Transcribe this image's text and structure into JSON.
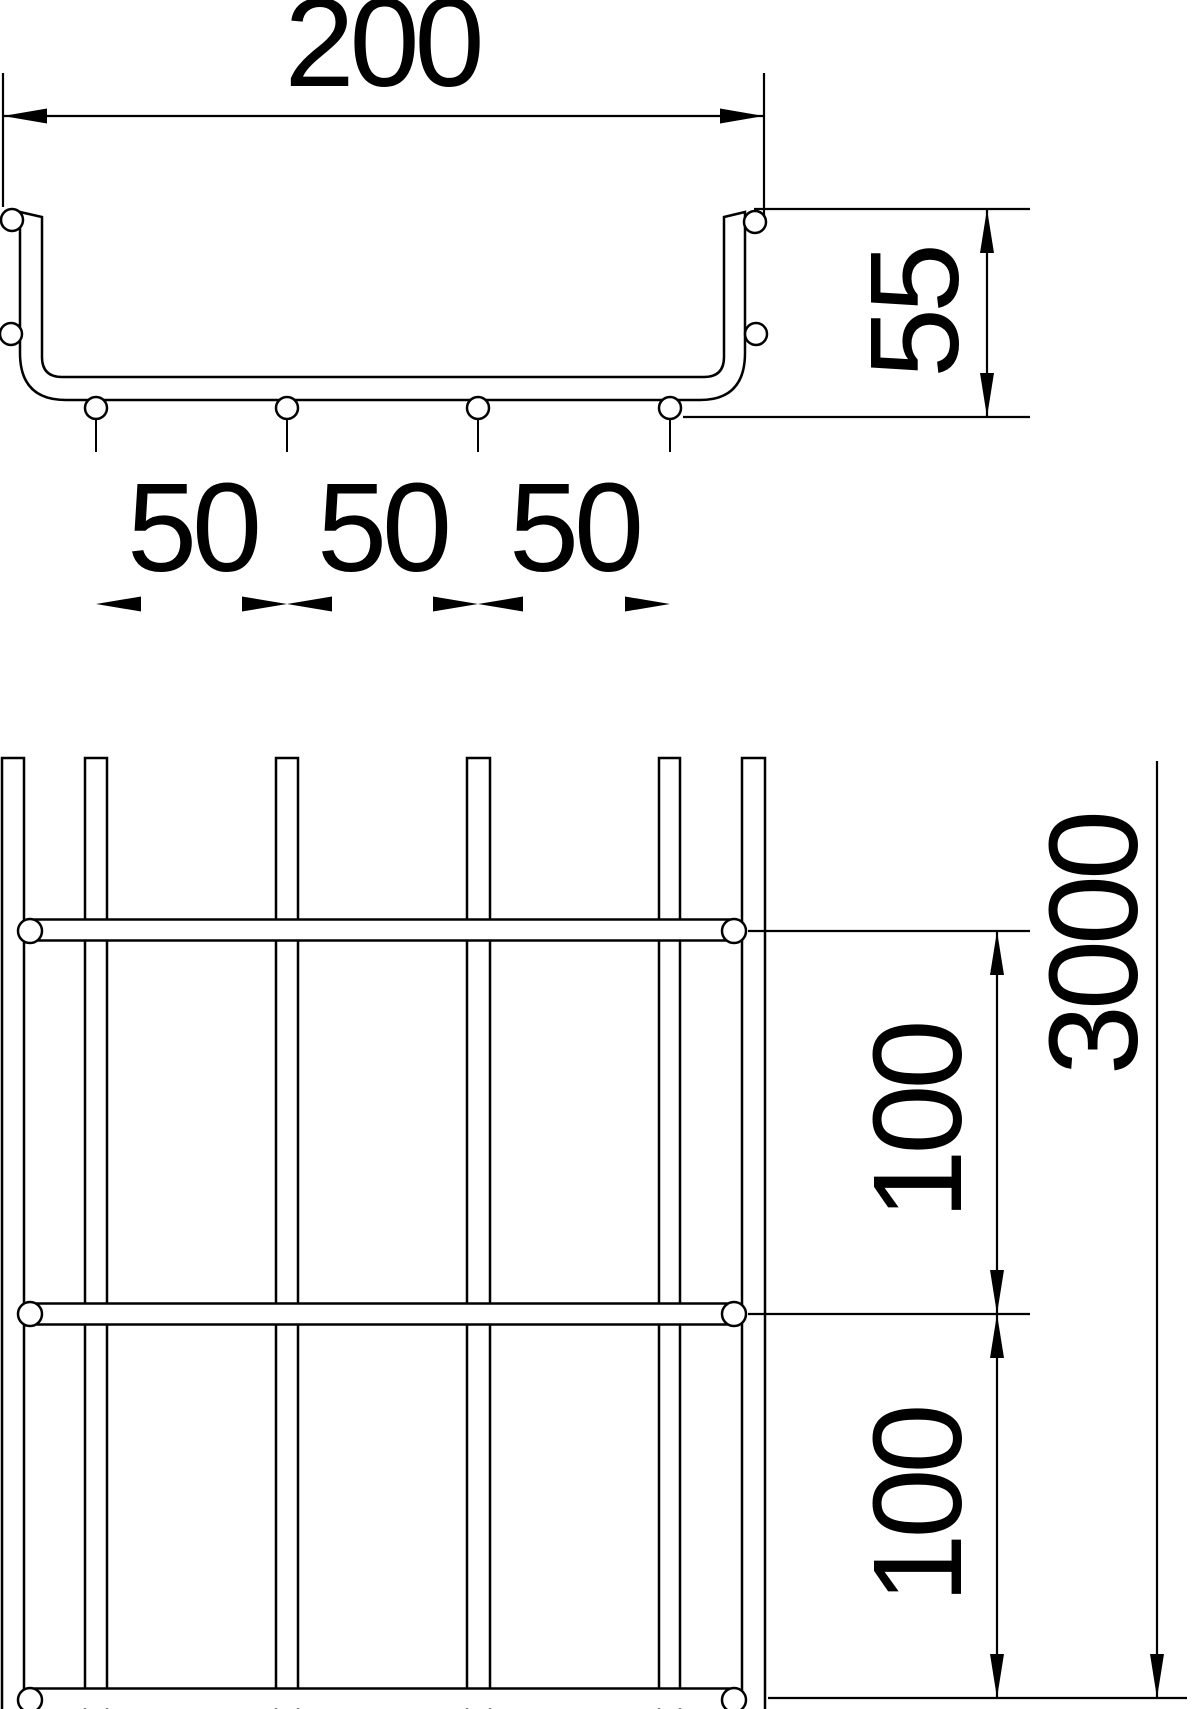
{
  "colors": {
    "background": "#ffffff",
    "line": "#000000",
    "text": "#000000"
  },
  "cross_section": {
    "width_label": "200",
    "height_label": "55",
    "wire_spacing_labels": [
      "50",
      "50",
      "50"
    ]
  },
  "plan_view": {
    "length_label": "3000",
    "cross_wire_pitch_labels": [
      "100",
      "100"
    ]
  }
}
